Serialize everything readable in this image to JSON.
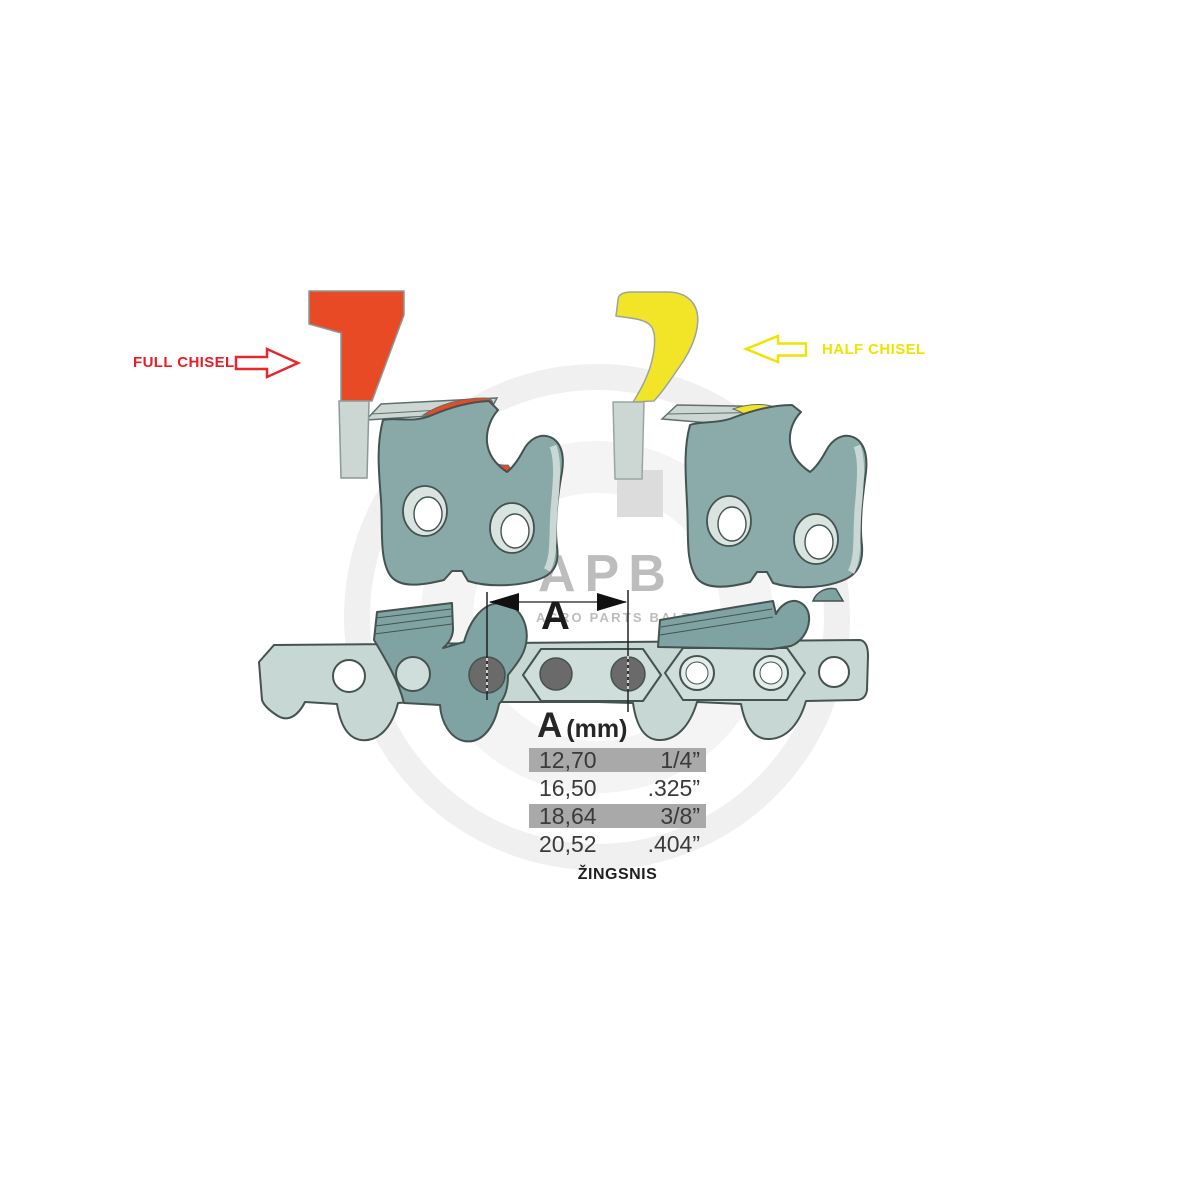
{
  "canvas": {
    "width": 1188,
    "height": 1188,
    "background": "#ffffff"
  },
  "annotations": {
    "full_chisel": {
      "label": "FULL CHISEL",
      "color": "#ed1c24"
    },
    "half_chisel": {
      "label": "HALF CHISEL",
      "color": "#f2e200"
    }
  },
  "dimension": {
    "letter": "A"
  },
  "pitch_table": {
    "header": {
      "letter": "A",
      "unit": "(mm)"
    },
    "rows": [
      {
        "mm": "12,70",
        "inch": "1/4”",
        "highlighted": true
      },
      {
        "mm": "16,50",
        "inch": ".325”",
        "highlighted": false
      },
      {
        "mm": "18,64",
        "inch": "3/8”",
        "highlighted": true
      },
      {
        "mm": "20,52",
        "inch": ".404”",
        "highlighted": false
      }
    ],
    "caption": "ŽINGSNIS",
    "highlight_color": "#a9a9a9"
  },
  "watermark": {
    "logo": "APB",
    "subtitle": "AGRO PARTS BALTIJA",
    "color": "#bdbdbd"
  },
  "illustration_colors": {
    "cutter_red": "#e84a26",
    "cutter_yellow": "#f2e426",
    "label_red": "#ed1c24",
    "label_yellow": "#f2e200",
    "link_teal": "#88a9a7",
    "chain_light_teal": "#c7d8d4",
    "cutter_dark_teal": "#7ea3a2",
    "steel_gray": "#ccd6d3",
    "rivet_gray": "#6a6a6a",
    "outline": "#44534f",
    "table_highlight": "#a9a9a9"
  }
}
